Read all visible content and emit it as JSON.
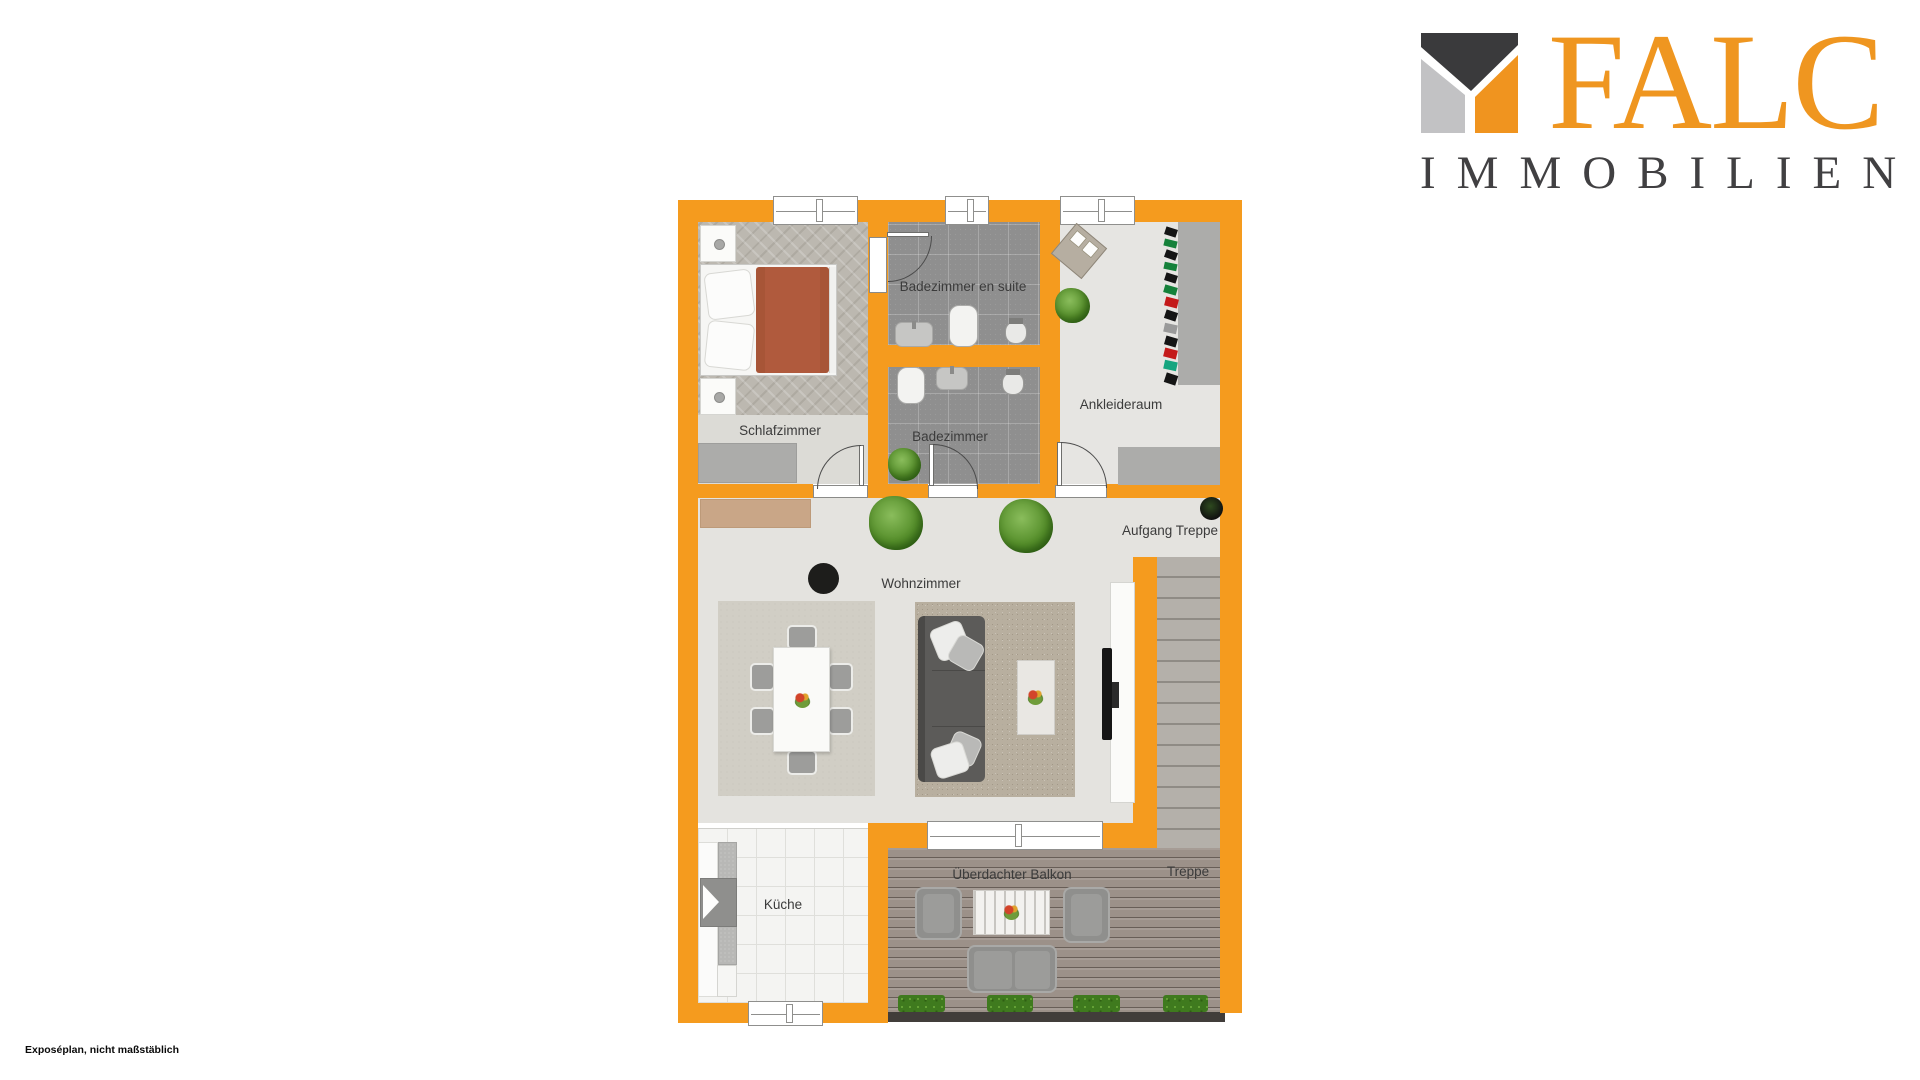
{
  "logo": {
    "brand": "FALC",
    "subtitle": "IMMOBILIEN",
    "brand_color": "#EF9620",
    "subtitle_color": "#414042",
    "mark_colors": {
      "dark": "#3A3A3C",
      "gray": "#C2C2C4",
      "orange": "#F0941F"
    }
  },
  "floorplan": {
    "wall_color": "#F59B1E",
    "rooms": {
      "schlafzimmer": {
        "label": "Schlafzimmer"
      },
      "badezimmer_en_suite": {
        "label": "Badezimmer en suite"
      },
      "badezimmer": {
        "label": "Badezimmer"
      },
      "ankleideraum": {
        "label": "Ankleideraum"
      },
      "wohnzimmer": {
        "label": "Wohnzimmer"
      },
      "kueche": {
        "label": "Küche"
      },
      "balkon": {
        "label": "Überdachter Balkon"
      }
    },
    "annotations": {
      "aufgang_treppe": {
        "label": "Aufgang Treppe"
      },
      "treppe": {
        "label": "Treppe"
      }
    }
  },
  "footer": {
    "disclaimer": "Exposéplan, nicht maßstäblich"
  }
}
